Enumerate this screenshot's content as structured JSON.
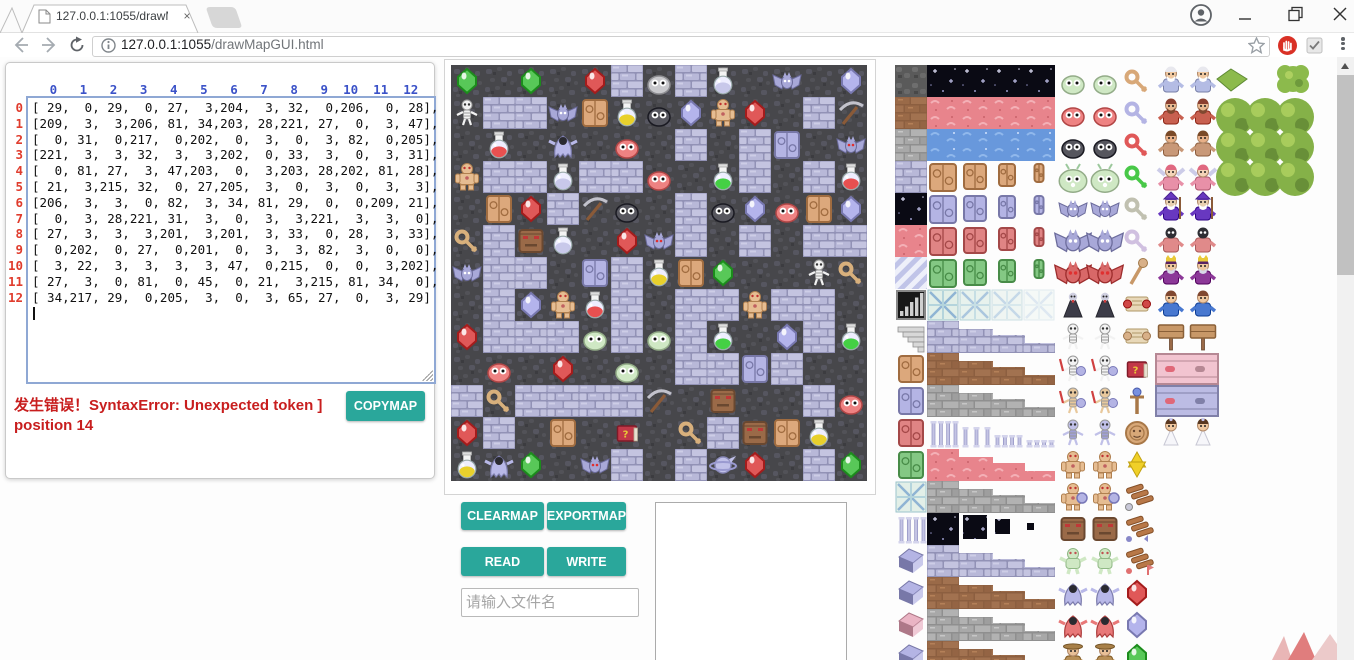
{
  "browser": {
    "tab": {
      "title": "127.0.0.1:1055/drawMa",
      "close_label": "×"
    },
    "url": {
      "host": "127.0.0.1:1055",
      "path": "/drawMapGUI.html"
    }
  },
  "panel": {
    "col_headers": [
      0,
      1,
      2,
      3,
      4,
      5,
      6,
      7,
      8,
      9,
      10,
      11,
      12
    ],
    "row_headers": [
      0,
      1,
      2,
      3,
      4,
      5,
      6,
      7,
      8,
      9,
      10,
      11,
      12
    ],
    "matrix": [
      [
        29,
        0,
        29,
        0,
        27,
        3,
        204,
        3,
        32,
        0,
        206,
        0,
        28
      ],
      [
        209,
        3,
        3,
        206,
        81,
        34,
        203,
        28,
        221,
        27,
        0,
        3,
        47
      ],
      [
        0,
        31,
        0,
        217,
        0,
        202,
        0,
        3,
        0,
        3,
        82,
        0,
        205
      ],
      [
        221,
        3,
        3,
        32,
        3,
        3,
        202,
        0,
        33,
        3,
        0,
        3,
        31
      ],
      [
        0,
        81,
        27,
        3,
        47,
        203,
        0,
        3,
        203,
        28,
        202,
        81,
        28
      ],
      [
        21,
        3,
        215,
        32,
        0,
        27,
        205,
        3,
        0,
        3,
        0,
        3,
        3
      ],
      [
        206,
        3,
        3,
        0,
        82,
        3,
        34,
        81,
        29,
        0,
        0,
        209,
        21
      ],
      [
        0,
        3,
        28,
        221,
        31,
        3,
        0,
        3,
        3,
        221,
        3,
        3,
        0
      ],
      [
        27,
        3,
        3,
        3,
        201,
        3,
        201,
        3,
        33,
        0,
        28,
        3,
        33
      ],
      [
        0,
        202,
        0,
        27,
        0,
        201,
        0,
        3,
        3,
        82,
        3,
        0,
        0
      ],
      [
        3,
        22,
        3,
        3,
        3,
        3,
        47,
        0,
        215,
        0,
        0,
        3,
        202
      ],
      [
        27,
        3,
        0,
        81,
        0,
        45,
        0,
        21,
        3,
        215,
        81,
        34,
        0
      ],
      [
        34,
        217,
        29,
        0,
        205,
        3,
        0,
        3,
        65,
        27,
        0,
        3,
        29
      ]
    ],
    "error_text": "发生错误！SyntaxError: Unexpected token ] position 14",
    "copymap_label": "COPYMAP"
  },
  "buttons": {
    "clearmap": "CLEARMAP",
    "exportmap": "EXPORTMAP",
    "read": "READ",
    "write": "WRITE"
  },
  "file_input": {
    "placeholder": "请输入文件名",
    "value": ""
  },
  "colors": {
    "accent_teal": "#2aa79b",
    "error_red": "#c81e1e",
    "header_blue": "#3b52c8",
    "rownum_red": "#e03c2d",
    "wall": "#b4b4d8",
    "floor": "#47474b"
  },
  "map": {
    "columns": 13,
    "rows": 13,
    "tile_size": 32
  },
  "tileset": {
    "left_column": [
      "darkstone",
      "dirt",
      "graystone",
      "brick",
      "starry",
      "redterrain",
      "diag",
      "bars",
      "stairs",
      "door:#dca87c",
      "door:#b4b4e4",
      "door:#e08484",
      "door:#84c884",
      "crystal",
      "pillar",
      "block:#b4b4e4",
      "block:#b4b4e4",
      "block:#eab4c4",
      "block:#b4b4e4"
    ],
    "wide_rows": [
      "starry",
      "redterrain",
      "water",
      "doors:#dca87c",
      "doors:#b4b4e4",
      "doors:#e08484",
      "doors:#84c884",
      "crystaldoors",
      "strips:brick",
      "strips:dirt",
      "strips:graystone",
      "pillarsrow",
      "strips:redterrain",
      "strips:graystone",
      "shrink:starry",
      "strips:brick",
      "strips:dirt",
      "strips:graystone",
      "strips:dirt"
    ],
    "monsters": [
      "slime:#cfe8c4",
      "slime:#ee8282",
      "slime:#56565e",
      "bigslime",
      "bat",
      "bigbat",
      "redbat",
      "vampire",
      "skeleton",
      "skelarm",
      "skelarm2",
      "skelarmor",
      "golem",
      "golemshield",
      "stoneface",
      "troll",
      "ghost:#b8b8e8",
      "ghost:#e87878",
      "hooded"
    ],
    "items": [
      "key:#d8a878",
      "key:#b4b4e4",
      "key:#e05858",
      "key:#48c848",
      "key:#c0c0b0",
      "key:#d0c0e0",
      "staff",
      "scroll:#d04848",
      "scroll:#d8b088",
      "book",
      "orbstaff",
      "medal",
      "star",
      "wing1",
      "wing2",
      "wing3",
      "gem:#e05858",
      "gem:#b4b4ec",
      "gem:#58c858"
    ],
    "characters": [
      "oldman",
      "dwarf",
      "fighter",
      "fairy",
      "wizard",
      "skullpriest",
      "king",
      "boy",
      "sign",
      "wallface:#f2c4d0",
      "wallface:#bcbce4",
      "bride"
    ]
  }
}
